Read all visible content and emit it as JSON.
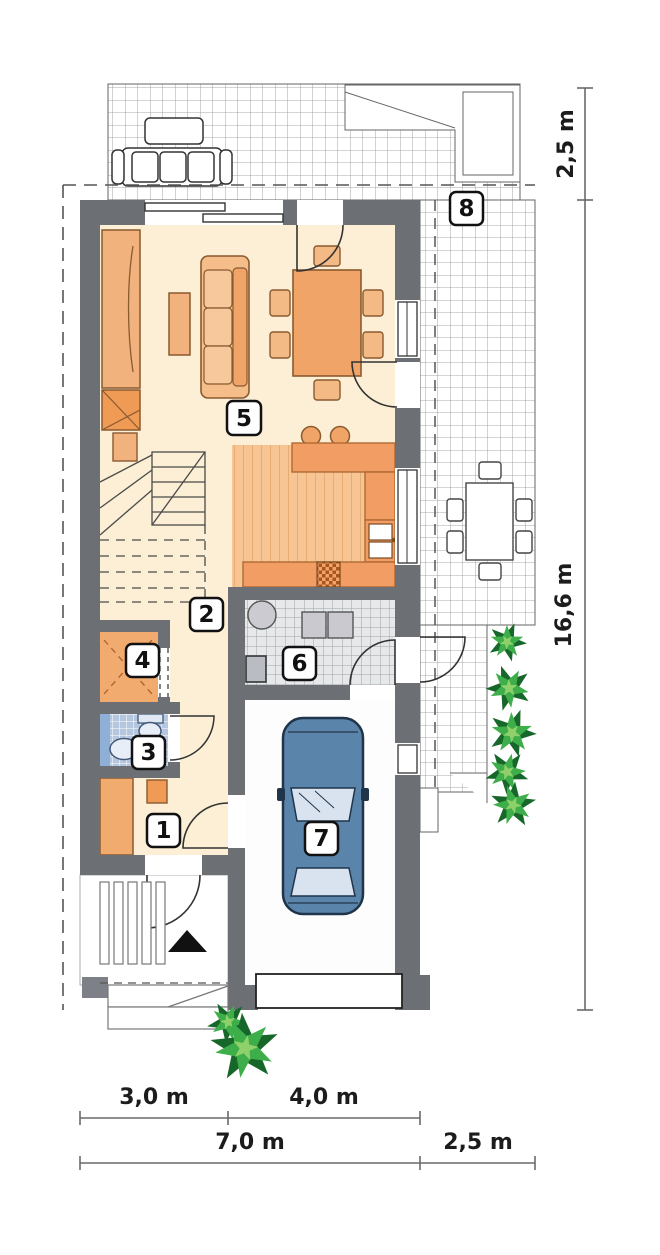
{
  "plan": {
    "type": "floor-plan",
    "room_labels": [
      "1",
      "2",
      "3",
      "4",
      "5",
      "6",
      "7",
      "8"
    ],
    "dimensions": {
      "right_top": "2,5 m",
      "right_side": "16,6 m",
      "bottom_row1": [
        "3,0 m",
        "4,0 m"
      ],
      "bottom_row2": [
        "7,0 m",
        "2,5 m"
      ]
    },
    "colors": {
      "wall": "#6c7075",
      "floor_cream": "#fcefd5",
      "furniture_orange": "#f1a469",
      "counter_orange": "#f19d63",
      "wood_floor": "#f7c493",
      "bath_tile_blue": "#b4c7de",
      "utility_tile": "#e7e8ea",
      "car_blue": "#5b84ab",
      "plant_green": "#3dae49",
      "label_border": "#111111",
      "dimension_text": "#1c1c1c"
    }
  }
}
